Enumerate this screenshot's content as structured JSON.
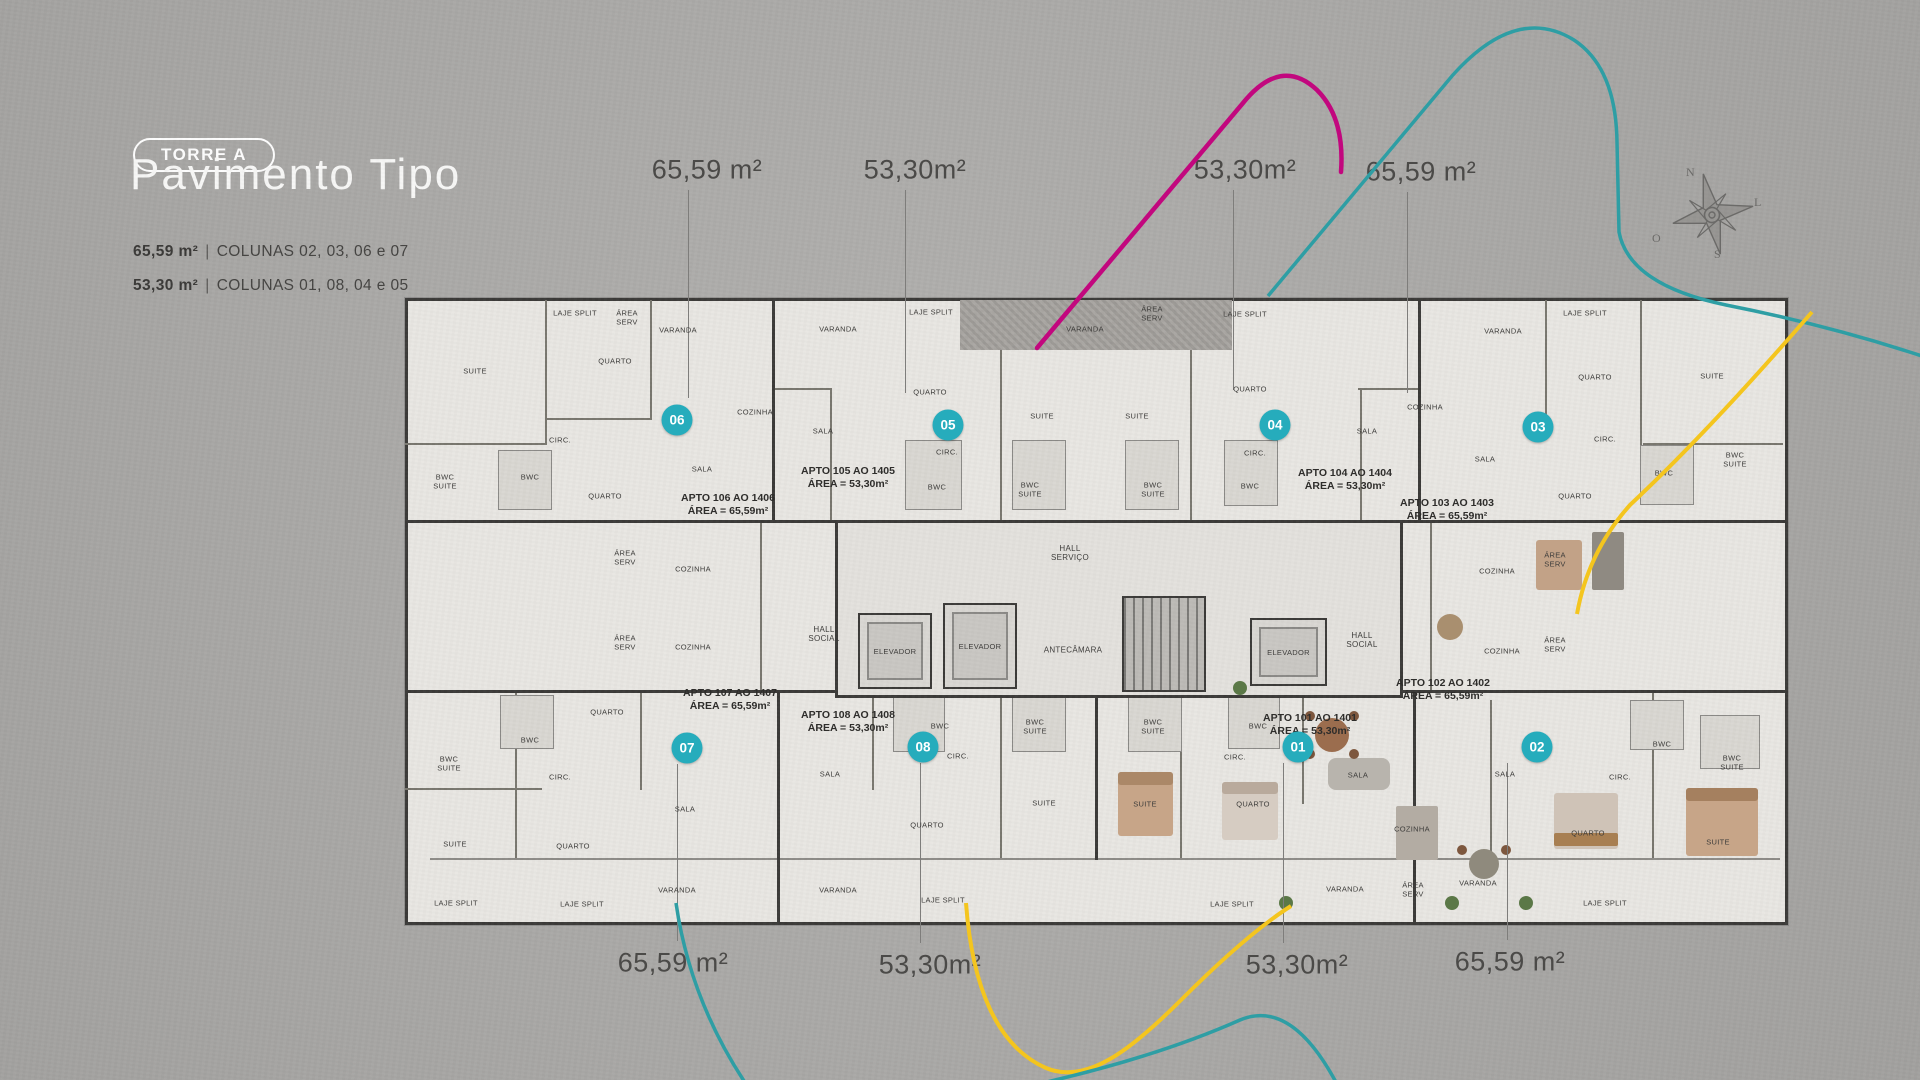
{
  "header": {
    "tower_badge": "TORRE A",
    "title": "Pavimento Tipo"
  },
  "legend": [
    {
      "area": "65,59 m²",
      "cols": "COLUNAS  02, 03, 06 e 07"
    },
    {
      "area": "53,30 m²",
      "cols": "COLUNAS  01, 08, 04 e 05"
    }
  ],
  "compass": {
    "n": "N",
    "s": "S",
    "e": "L",
    "w": "O"
  },
  "callouts_top": [
    {
      "text": "65,59 m²",
      "x": 707,
      "y": 170,
      "lx": 688,
      "ly1": 190,
      "ly2": 398
    },
    {
      "text": "53,30m²",
      "x": 915,
      "y": 170,
      "lx": 905,
      "ly1": 190,
      "ly2": 393
    },
    {
      "text": "53,30m²",
      "x": 1245,
      "y": 170,
      "lx": 1233,
      "ly1": 190,
      "ly2": 390
    },
    {
      "text": "65,59 m²",
      "x": 1421,
      "y": 172,
      "lx": 1407,
      "ly1": 192,
      "ly2": 393
    }
  ],
  "callouts_bottom": [
    {
      "text": "65,59 m²",
      "x": 673,
      "y": 963,
      "lx": 677,
      "ly1": 764,
      "ly2": 941
    },
    {
      "text": "53,30m²",
      "x": 930,
      "y": 965,
      "lx": 920,
      "ly1": 763,
      "ly2": 943
    },
    {
      "text": "53,30m²",
      "x": 1297,
      "y": 965,
      "lx": 1283,
      "ly1": 763,
      "ly2": 943
    },
    {
      "text": "65,59 m²",
      "x": 1510,
      "y": 962,
      "lx": 1507,
      "ly1": 763,
      "ly2": 940
    }
  ],
  "badges": [
    {
      "n": "06",
      "x": 677,
      "y": 420
    },
    {
      "n": "05",
      "x": 948,
      "y": 425
    },
    {
      "n": "04",
      "x": 1275,
      "y": 425
    },
    {
      "n": "03",
      "x": 1538,
      "y": 427
    },
    {
      "n": "07",
      "x": 687,
      "y": 748
    },
    {
      "n": "08",
      "x": 923,
      "y": 747
    },
    {
      "n": "01",
      "x": 1298,
      "y": 747
    },
    {
      "n": "02",
      "x": 1537,
      "y": 747
    }
  ],
  "apartments": [
    {
      "l1": "APTO 106 AO 1406",
      "l2": "ÁREA = 65,59m²",
      "x": 728,
      "y": 505
    },
    {
      "l1": "APTO 105 AO 1405",
      "l2": "ÁREA = 53,30m²",
      "x": 848,
      "y": 478
    },
    {
      "l1": "APTO 104 AO 1404",
      "l2": "ÁREA = 53,30m²",
      "x": 1345,
      "y": 480
    },
    {
      "l1": "APTO 103 AO 1403",
      "l2": "ÁREA = 65,59m²",
      "x": 1447,
      "y": 510
    },
    {
      "l1": "APTO 107 AO 1407",
      "l2": "ÁREA = 65,59m²",
      "x": 730,
      "y": 700
    },
    {
      "l1": "APTO 108 AO 1408",
      "l2": "ÁREA = 53,30m²",
      "x": 848,
      "y": 722
    },
    {
      "l1": "APTO 101 AO 1401",
      "l2": "ÁREA = 53,30m²",
      "x": 1310,
      "y": 725
    },
    {
      "l1": "APTO 102 AO 1402",
      "l2": "ÁREA = 65,59m²",
      "x": 1443,
      "y": 690
    }
  ],
  "core_labels": [
    {
      "t": "HALL\nSERVIÇO",
      "x": 1070,
      "y": 553
    },
    {
      "t": "ANTECÂMARA",
      "x": 1073,
      "y": 650
    },
    {
      "t": "HALL\nSOCIAL",
      "x": 824,
      "y": 634
    },
    {
      "t": "HALL\nSOCIAL",
      "x": 1362,
      "y": 640
    }
  ],
  "elevator_label": "ELEVADOR",
  "rooms": [
    {
      "t": "LAJE SPLIT",
      "x": 575,
      "y": 314
    },
    {
      "t": "ÁREA\nSERV",
      "x": 627,
      "y": 318
    },
    {
      "t": "VARANDA",
      "x": 678,
      "y": 331
    },
    {
      "t": "VARANDA",
      "x": 838,
      "y": 330
    },
    {
      "t": "LAJE SPLIT",
      "x": 931,
      "y": 313
    },
    {
      "t": "VARANDA",
      "x": 1085,
      "y": 330
    },
    {
      "t": "ÁREA\nSERV",
      "x": 1152,
      "y": 314
    },
    {
      "t": "LAJE SPLIT",
      "x": 1245,
      "y": 315
    },
    {
      "t": "VARANDA",
      "x": 1503,
      "y": 332
    },
    {
      "t": "LAJE SPLIT",
      "x": 1585,
      "y": 314
    },
    {
      "t": "SUITE",
      "x": 475,
      "y": 372
    },
    {
      "t": "QUARTO",
      "x": 615,
      "y": 362
    },
    {
      "t": "QUARTO",
      "x": 930,
      "y": 393
    },
    {
      "t": "SUITE",
      "x": 1042,
      "y": 417
    },
    {
      "t": "SUITE",
      "x": 1137,
      "y": 417
    },
    {
      "t": "QUARTO",
      "x": 1250,
      "y": 390
    },
    {
      "t": "QUARTO",
      "x": 1595,
      "y": 378
    },
    {
      "t": "SUITE",
      "x": 1712,
      "y": 377
    },
    {
      "t": "CIRC.",
      "x": 560,
      "y": 441
    },
    {
      "t": "COZINHA",
      "x": 755,
      "y": 413
    },
    {
      "t": "SALA",
      "x": 823,
      "y": 432
    },
    {
      "t": "CIRC.",
      "x": 947,
      "y": 453
    },
    {
      "t": "BWC",
      "x": 937,
      "y": 488
    },
    {
      "t": "BWC\nSUITE",
      "x": 1030,
      "y": 490
    },
    {
      "t": "BWC\nSUITE",
      "x": 1153,
      "y": 490
    },
    {
      "t": "BWC",
      "x": 1250,
      "y": 487
    },
    {
      "t": "CIRC.",
      "x": 1255,
      "y": 454
    },
    {
      "t": "SALA",
      "x": 1367,
      "y": 432
    },
    {
      "t": "COZINHA",
      "x": 1425,
      "y": 408
    },
    {
      "t": "CIRC.",
      "x": 1605,
      "y": 440
    },
    {
      "t": "SALA",
      "x": 702,
      "y": 470
    },
    {
      "t": "QUARTO",
      "x": 605,
      "y": 497
    },
    {
      "t": "BWC",
      "x": 530,
      "y": 478
    },
    {
      "t": "BWC\nSUITE",
      "x": 445,
      "y": 482
    },
    {
      "t": "SALA",
      "x": 1485,
      "y": 460
    },
    {
      "t": "QUARTO",
      "x": 1575,
      "y": 497
    },
    {
      "t": "BWC",
      "x": 1664,
      "y": 474
    },
    {
      "t": "BWC\nSUITE",
      "x": 1735,
      "y": 460
    },
    {
      "t": "ÁREA\nSERV",
      "x": 625,
      "y": 558
    },
    {
      "t": "COZINHA",
      "x": 693,
      "y": 570
    },
    {
      "t": "ÁREA\nSERV",
      "x": 1555,
      "y": 560
    },
    {
      "t": "COZINHA",
      "x": 1497,
      "y": 572
    },
    {
      "t": "ÁREA\nSERV",
      "x": 625,
      "y": 643
    },
    {
      "t": "COZINHA",
      "x": 693,
      "y": 648
    },
    {
      "t": "ÁREA\nSERV",
      "x": 1555,
      "y": 645
    },
    {
      "t": "COZINHA",
      "x": 1502,
      "y": 652
    },
    {
      "t": "BWC\nSUITE",
      "x": 449,
      "y": 764
    },
    {
      "t": "BWC",
      "x": 530,
      "y": 741
    },
    {
      "t": "QUARTO",
      "x": 607,
      "y": 713
    },
    {
      "t": "CIRC.",
      "x": 560,
      "y": 778
    },
    {
      "t": "SUITE",
      "x": 455,
      "y": 845
    },
    {
      "t": "QUARTO",
      "x": 573,
      "y": 847
    },
    {
      "t": "SALA",
      "x": 685,
      "y": 810
    },
    {
      "t": "VARANDA",
      "x": 677,
      "y": 891
    },
    {
      "t": "LAJE SPLIT",
      "x": 582,
      "y": 905
    },
    {
      "t": "LAJE SPLIT",
      "x": 456,
      "y": 904
    },
    {
      "t": "SALA",
      "x": 830,
      "y": 775
    },
    {
      "t": "CIRC.",
      "x": 958,
      "y": 757
    },
    {
      "t": "BWC",
      "x": 940,
      "y": 727
    },
    {
      "t": "QUARTO",
      "x": 927,
      "y": 826
    },
    {
      "t": "VARANDA",
      "x": 838,
      "y": 891
    },
    {
      "t": "LAJE SPLIT",
      "x": 943,
      "y": 901
    },
    {
      "t": "BWC\nSUITE",
      "x": 1035,
      "y": 727
    },
    {
      "t": "SUITE",
      "x": 1044,
      "y": 804
    },
    {
      "t": "BWC\nSUITE",
      "x": 1153,
      "y": 727
    },
    {
      "t": "SUITE",
      "x": 1145,
      "y": 805
    },
    {
      "t": "BWC",
      "x": 1258,
      "y": 727
    },
    {
      "t": "CIRC.",
      "x": 1235,
      "y": 758
    },
    {
      "t": "QUARTO",
      "x": 1253,
      "y": 805
    },
    {
      "t": "SALA",
      "x": 1358,
      "y": 776
    },
    {
      "t": "COZINHA",
      "x": 1412,
      "y": 830
    },
    {
      "t": "VARANDA",
      "x": 1345,
      "y": 890
    },
    {
      "t": "ÁREA\nSERV",
      "x": 1413,
      "y": 890
    },
    {
      "t": "LAJE SPLIT",
      "x": 1232,
      "y": 905
    },
    {
      "t": "SALA",
      "x": 1505,
      "y": 775
    },
    {
      "t": "QUARTO",
      "x": 1588,
      "y": 834
    },
    {
      "t": "SUITE",
      "x": 1718,
      "y": 843
    },
    {
      "t": "BWC",
      "x": 1662,
      "y": 745
    },
    {
      "t": "BWC\nSUITE",
      "x": 1732,
      "y": 763
    },
    {
      "t": "CIRC.",
      "x": 1620,
      "y": 778
    },
    {
      "t": "VARANDA",
      "x": 1478,
      "y": 884
    },
    {
      "t": "LAJE SPLIT",
      "x": 1605,
      "y": 904
    }
  ],
  "colors": {
    "badge_teal": "#26acbc",
    "curve_teal": "#2e9ea4",
    "curve_magenta": "#c2077e",
    "curve_yellow": "#f4c51e",
    "wall": "#3c3b39",
    "floor": "#e8e6e2",
    "background": "#a9a8a6"
  }
}
